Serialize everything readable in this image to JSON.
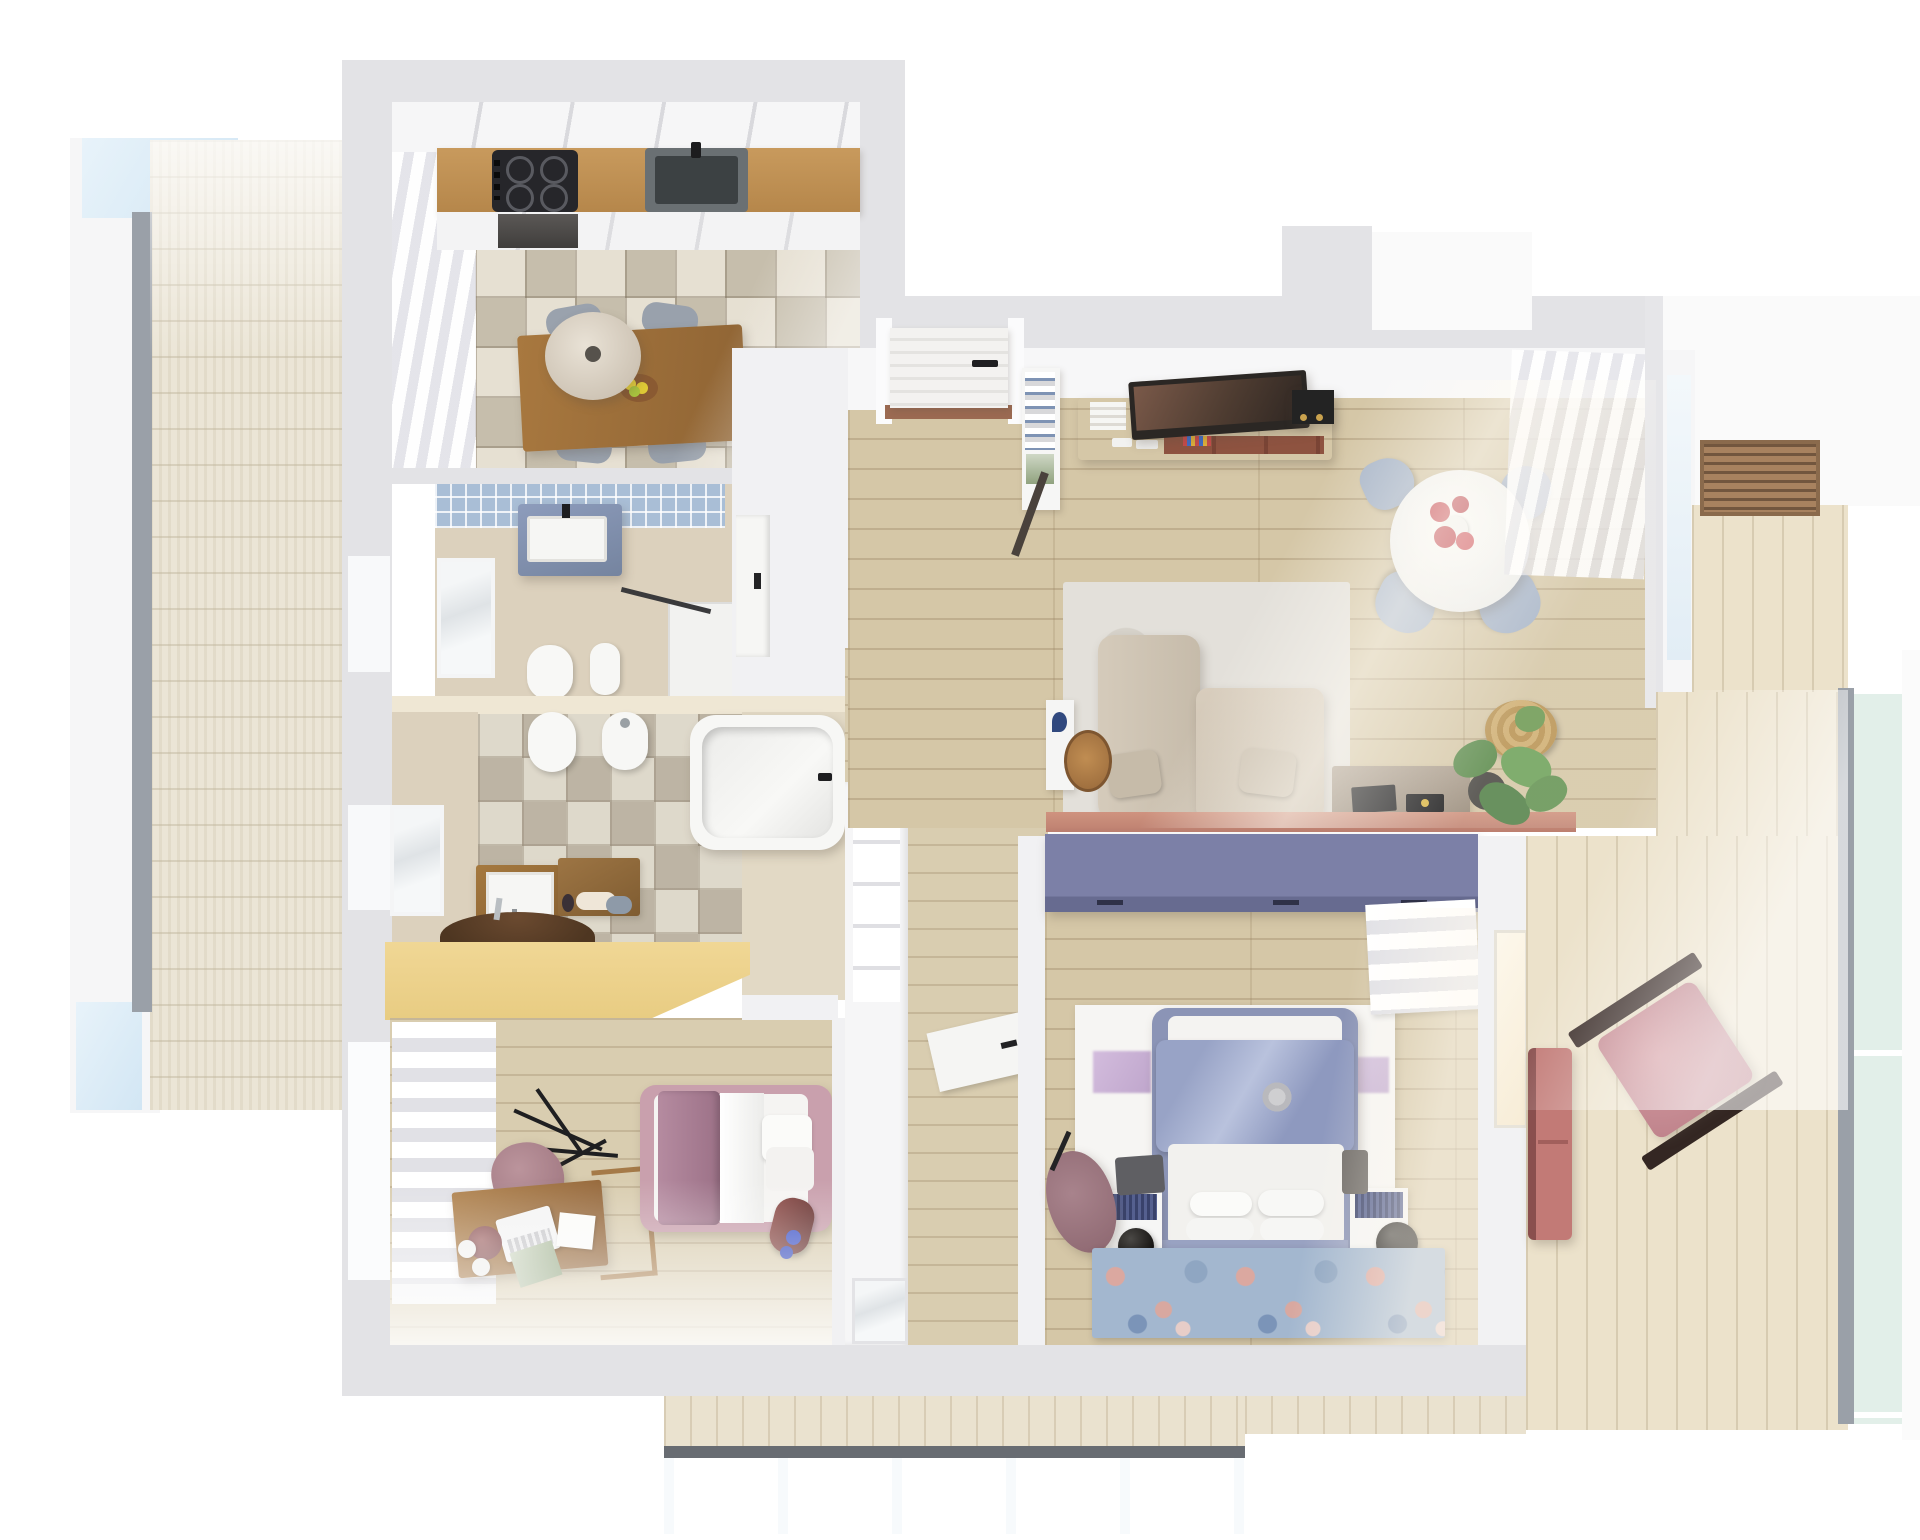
{
  "scene": {
    "title": "Apartment 3D floor plan – top-down render",
    "type": "architectural render, no visible text",
    "style": "photoreal dollhouse view of a two-bedroom apartment with three balconies"
  },
  "palette": {
    "wall_gray": "#e3e3e6",
    "inner_wall_white": "#f1f1f3",
    "wood_floor": "#d5c7a7",
    "deck_wood": "#ece2cb",
    "kitchen_tile": "#d6cfbf",
    "counter_wood": "#c39153",
    "table_wood": "#a0713f",
    "tv_console_terracotta": "#b26b50",
    "wardrobe_purple": "#7c80a7",
    "wardrobe_yellow": "#eed695",
    "vanity_blue": "#8090b2",
    "sofa_beige": "#cfc5b5",
    "bed_blue": "#8e99bf",
    "kids_bed_pink": "#c9a0ad",
    "armchair_mauve": "#9c7880",
    "accent_flower_red": "#c64a52",
    "balcony_glass_blue": "#cde3f3",
    "railing_glass_green": "#e2efe9"
  },
  "rooms": {
    "kitchen": {
      "label": "Kitchen and dining room",
      "items": "white upper cabinets, wood countertop, induction cooktop, sink, oven, patchwork tile floor, wood dining table, pendant lamp, four gray chairs, lemon bowl, sheer window curtain"
    },
    "bath_top": {
      "label": "Bathroom with shower",
      "items": "blue mosaic wall strip, blue vanity with white basin, frosted window, toilet, bidet, walk-in shower with glass panel"
    },
    "bath_bottom": {
      "label": "Bathroom with bathtub",
      "items": "patchwork tile floor, toilet, bidet, bathtub, wood vanity with basin, wood shelf with towels, round washbasin counter, frosted window"
    },
    "kids_room": {
      "label": "Kids bedroom",
      "items": "yellow wardrobe, roman blind window, wood desk with laptop and lamp, mauve desk chair, single bed with mauve blanket, dark red bolster"
    },
    "master_bedroom": {
      "label": "Master bedroom",
      "items": "purple wardrobe, double bed with periwinkle duvet, white headboard wall, two nightstands with navy tops, black sphere lamps, mauve armchair, floral rug, roman shade"
    },
    "living_room": {
      "label": "Living room",
      "items": "entrance door, white bookshelf, terracotta TV sideboard with TV, speaker box, round white dining table with red gerberas, four light-blue chairs, beige sofa, pale rug, side cabinet, wood disc table, gray sideboard with laptop and record, terracotta bench, monstera plant, straw hat, sheer curtains"
    },
    "hallway": {
      "label": "Hallway",
      "items": "dark console with round tray and pink flowers, white built-in closet, washer niche, interior doors"
    },
    "balcony_left": {
      "label": "Left terrace",
      "items": "whitewashed deck, window frames, glazing"
    },
    "balcony_right": {
      "label": "Right balcony",
      "items": "wood deck, louver vent grille, dark wood chair with pink cushion, pink loveseat, green glass railing"
    },
    "balcony_bottom": {
      "label": "Bottom balcony",
      "items": "wood deck, dark track, pale blue glass railing"
    }
  }
}
